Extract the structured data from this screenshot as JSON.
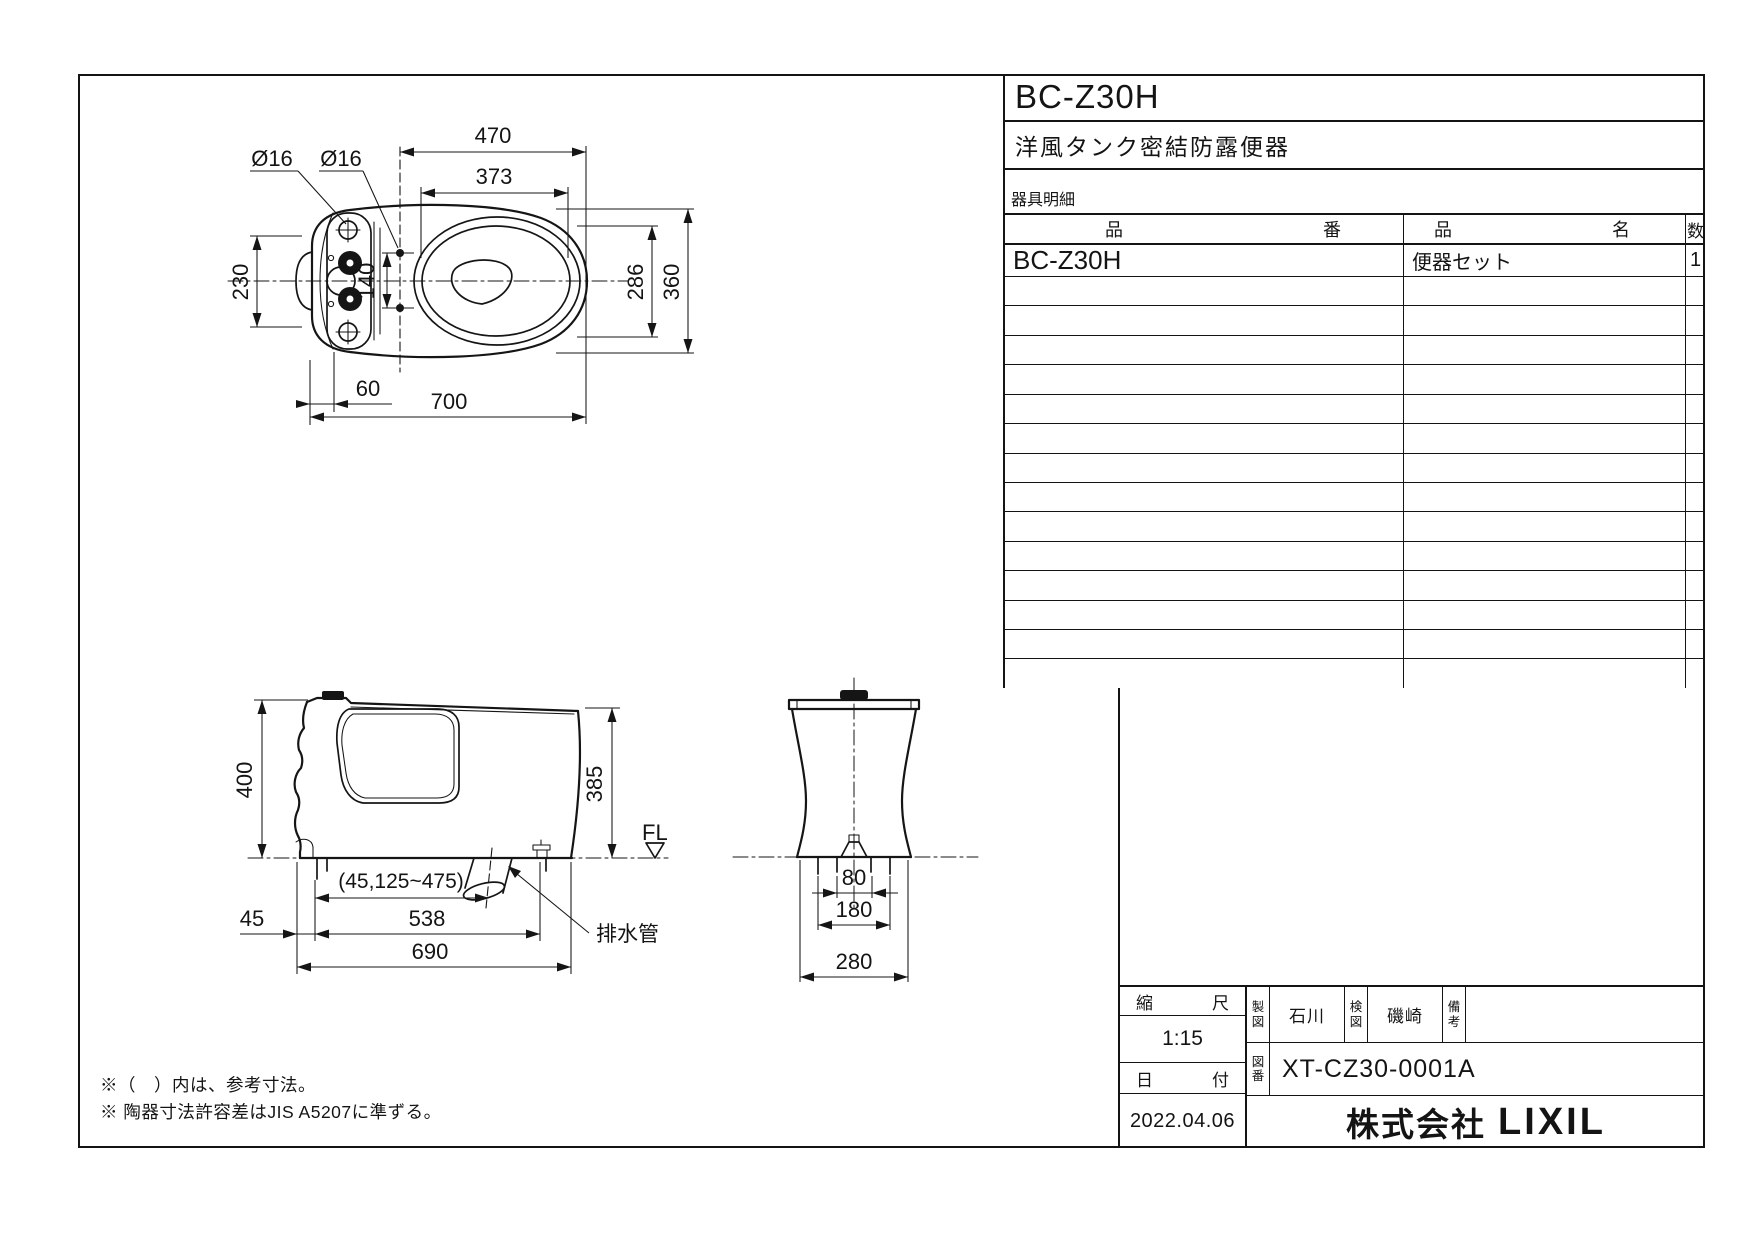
{
  "title_block": {
    "model": "BC-Z30H",
    "product_name": "洋風タンク密結防露便器",
    "parts_label": "器具明細",
    "col_part_no": [
      "品",
      "番"
    ],
    "col_name": [
      "品",
      "名"
    ],
    "col_qty": "数",
    "rows": [
      {
        "part_no": "BC-Z30H",
        "name": "便器セット",
        "qty": "1"
      }
    ],
    "empty_row_count": 14
  },
  "info_block": {
    "scale_label_l": "縮",
    "scale_label_r": "尺",
    "scale": "1:15",
    "date_label_l": "日",
    "date_label_r": "付",
    "date": "2022.04.06",
    "drawn_label": "製図",
    "drawn_by": "石川",
    "checked_label": "検図",
    "checked_by": "磯崎",
    "remarks_label": "備考",
    "remarks_value": "",
    "dwg_no_label": "図番",
    "dwg_no": "XT-CZ30-0001A",
    "company_prefix": "株式会社",
    "company_name": "LIXIL"
  },
  "notes": {
    "line1": "※（　）内は、参考寸法。",
    "line2": "※ 陶器寸法許容差はJIS A5207に準ずる。"
  },
  "views": {
    "top": {
      "d470": "470",
      "d373": "373",
      "dia1": "Ø16",
      "dia2": "Ø16",
      "d230": "230",
      "d140": "140",
      "d286": "286",
      "d360": "360",
      "d60": "60",
      "d700": "700"
    },
    "side": {
      "d400": "400",
      "d385": "385",
      "fl": "FL",
      "range": "(45,125~475)",
      "d45": "45",
      "d538": "538",
      "d690": "690",
      "drain": "排水管"
    },
    "front": {
      "d80": "80",
      "d180": "180",
      "d280": "280"
    }
  },
  "colors": {
    "ink": "#151515",
    "paper": "#ffffff"
  }
}
